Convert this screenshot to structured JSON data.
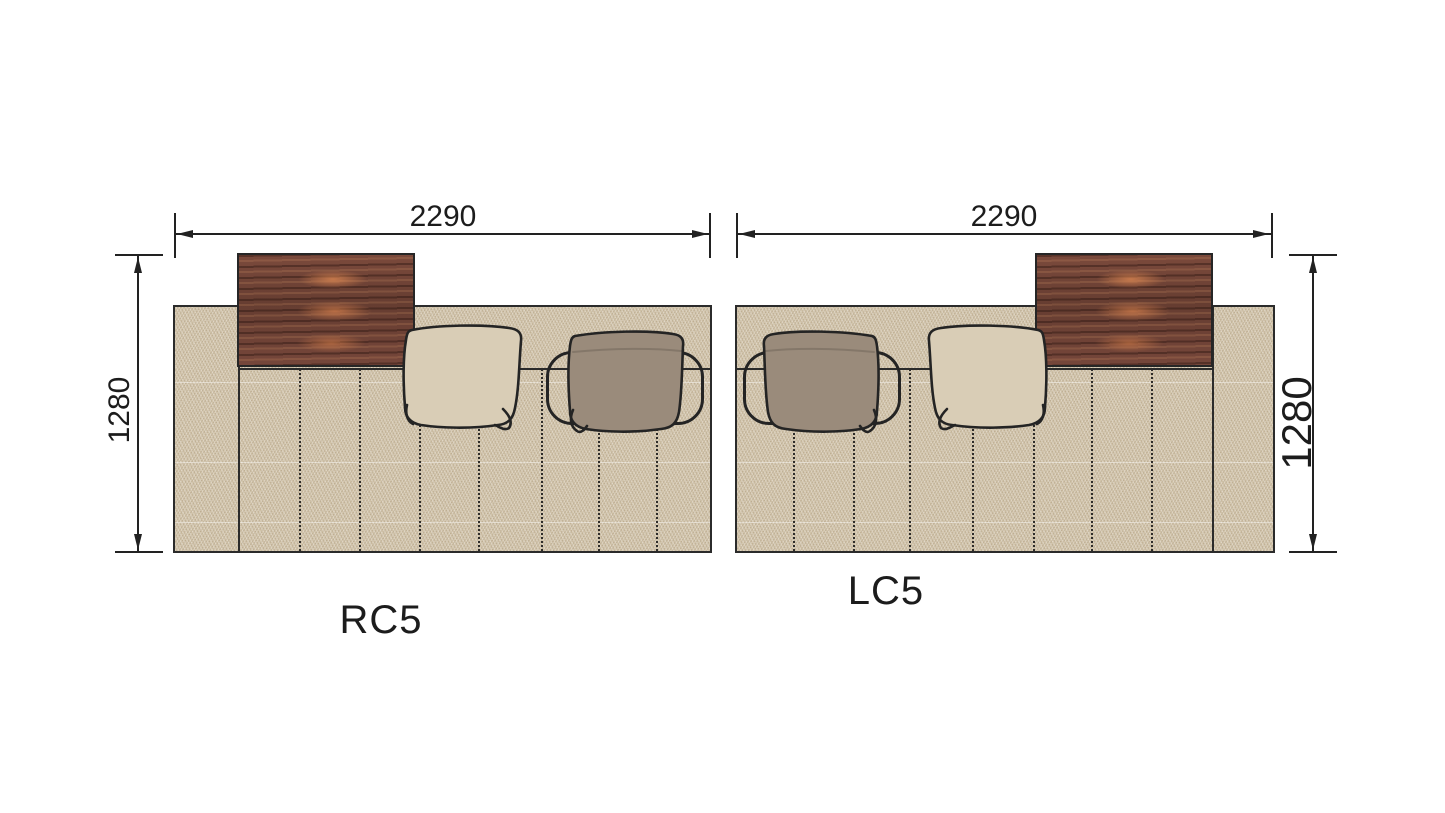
{
  "modules": [
    {
      "label": "RC5",
      "width_mm": "2290",
      "depth_mm": "1280"
    },
    {
      "label": "LC5",
      "width_mm": "2290",
      "depth_mm": "1280"
    }
  ],
  "colors": {
    "background": "#ffffff",
    "outline": "#262626",
    "fabric": "#d5c8b0",
    "cushion_beige": "#d9cdb6",
    "cushion_taupe": "#9a8b7b",
    "wood_base": "#6e4236",
    "wood_highlight": "#c87c4c"
  }
}
